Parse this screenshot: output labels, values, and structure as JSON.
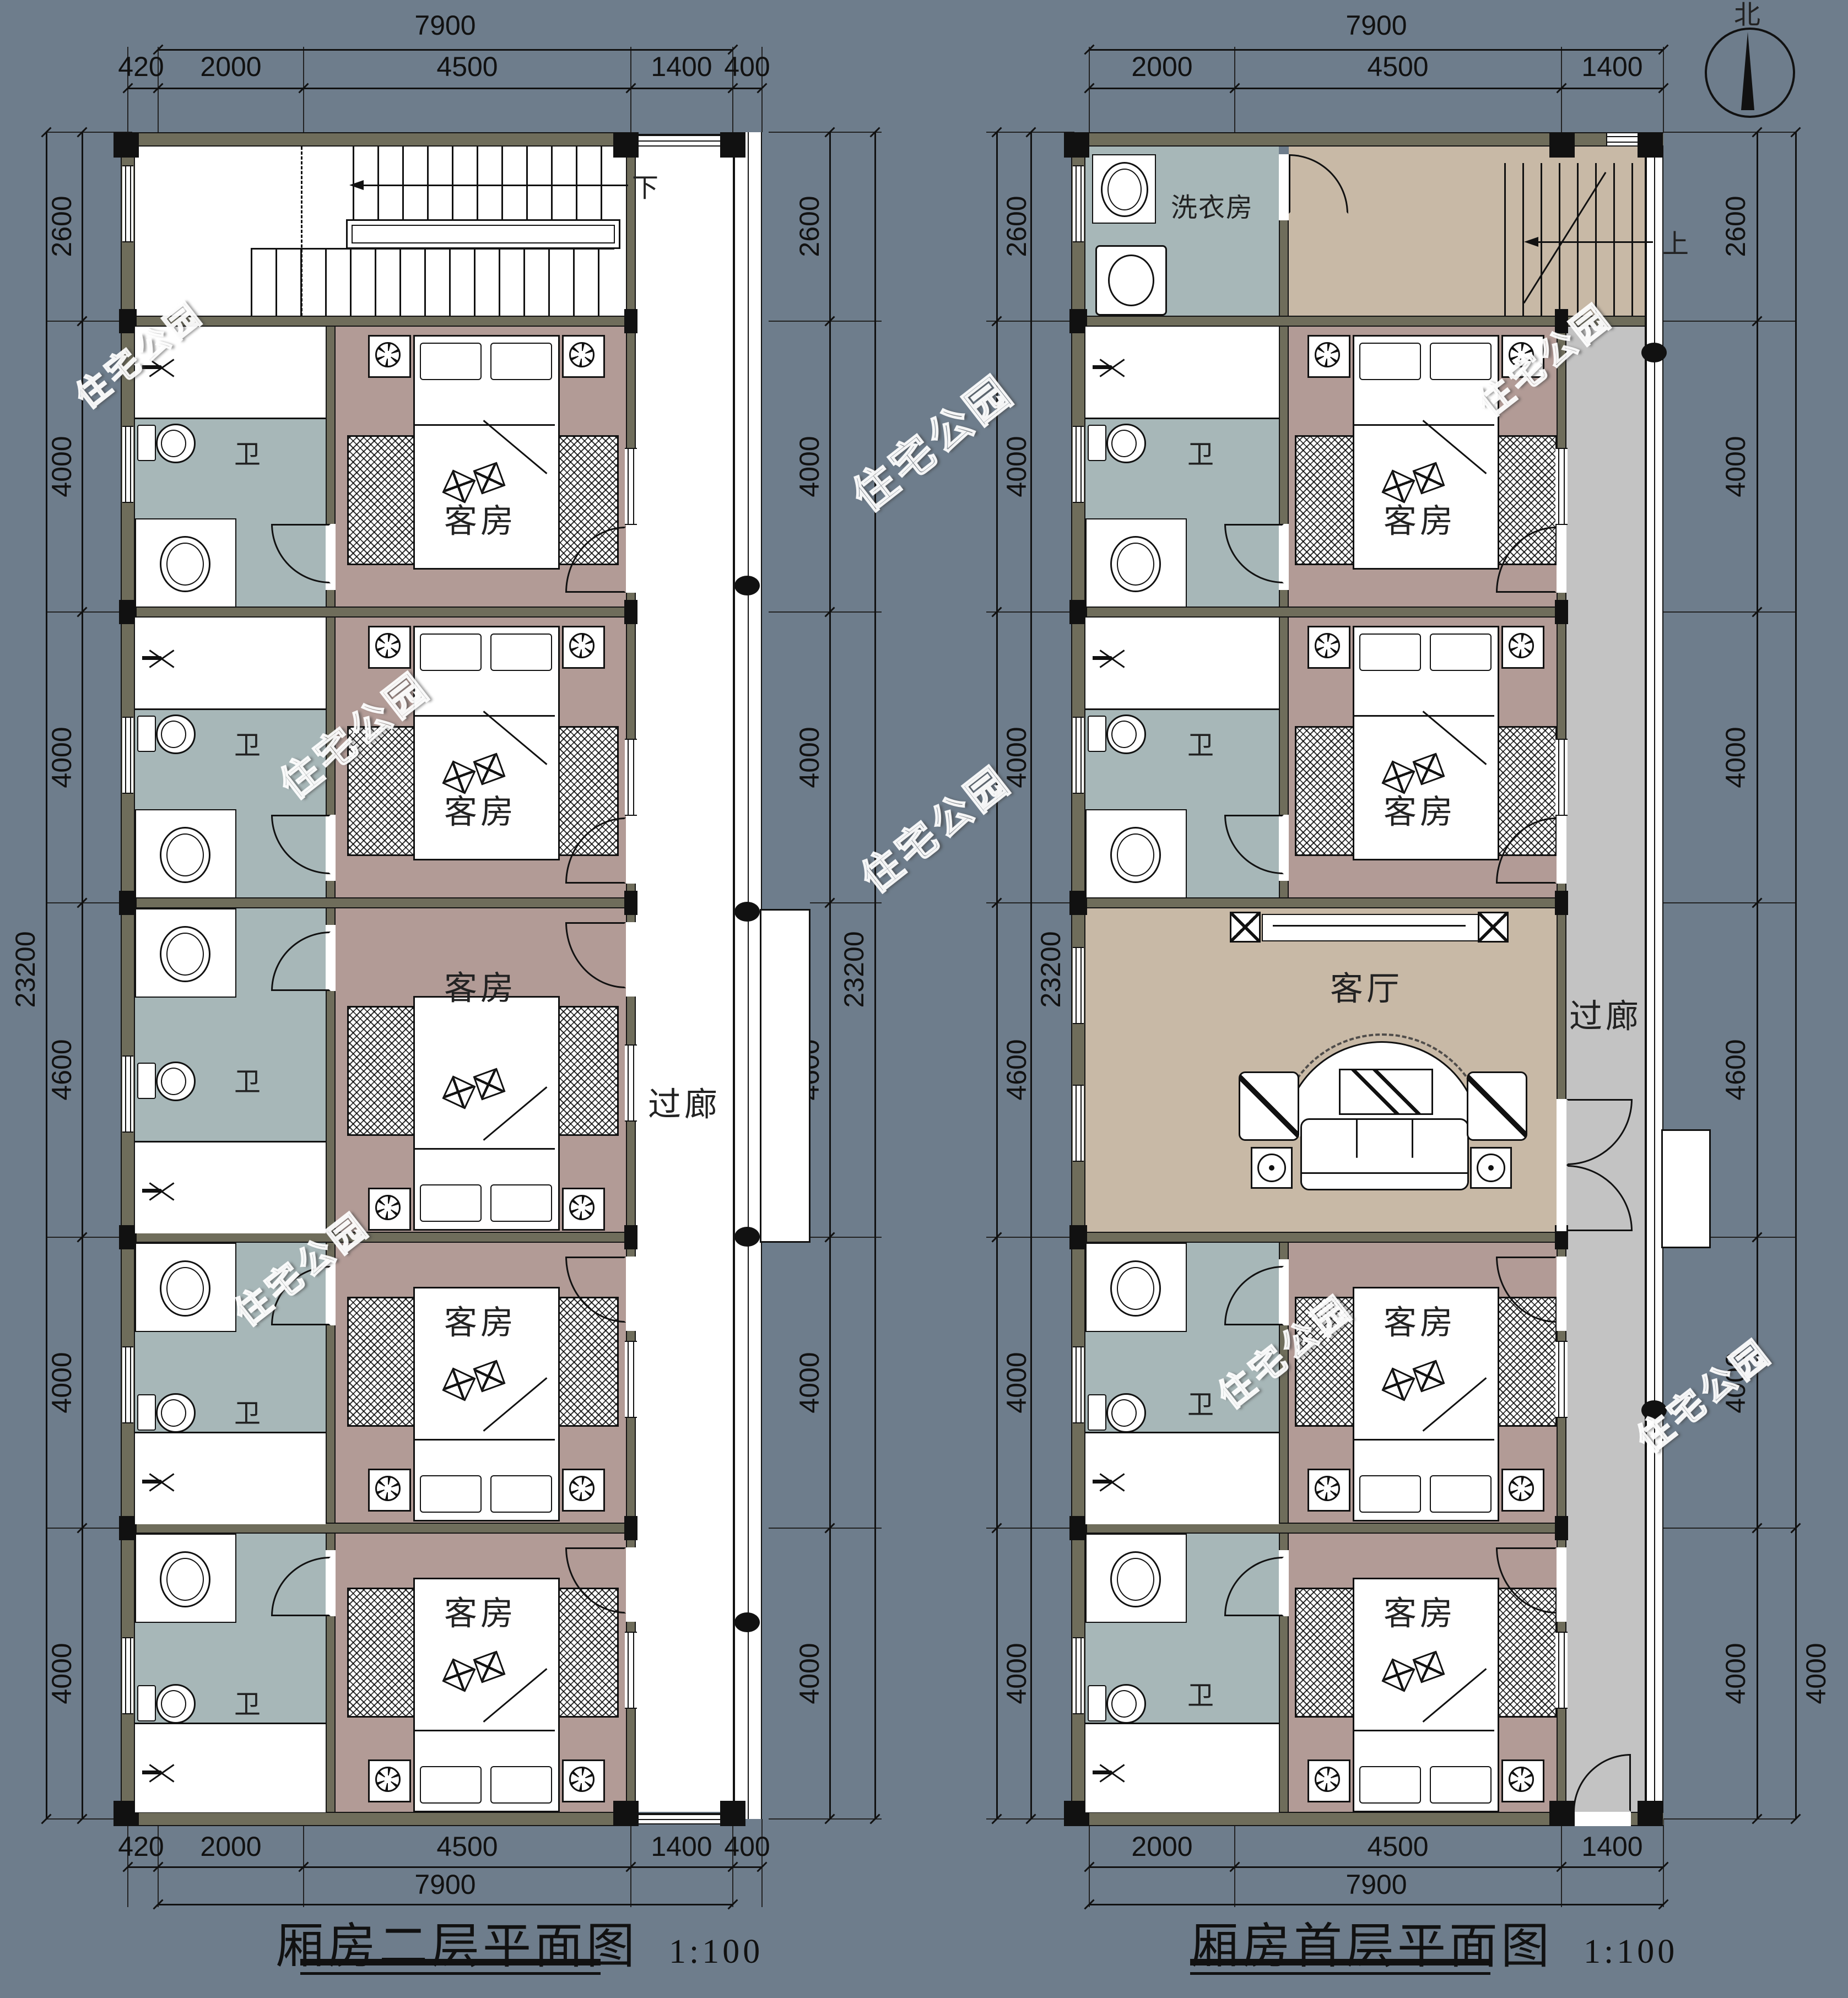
{
  "sheet": {
    "background_color": "#6e7d8c"
  },
  "colors": {
    "wall": "#6f6d5b",
    "line": "#111111",
    "bathroom_floor": "#a7b7b8",
    "bedroom_floor": "#b29b96",
    "living_floor": "#c8b9a6",
    "corridor_first_floor": "#c3c3c3",
    "corridor_second_floor": "#ffffff"
  },
  "watermark": "住宅公园",
  "compass": {
    "north_label": "北"
  },
  "room_labels": {
    "guest_room": "客房",
    "bathroom": "卫",
    "living_room": "客厅",
    "laundry": "洗衣房",
    "corridor": "过廊",
    "stairs_down": "下",
    "stairs_up": "上"
  },
  "left_plan": {
    "title": "厢房二层平面图",
    "scale_note": "1:100",
    "dims": {
      "top_overall": "7900",
      "top_segments": [
        "420",
        "2000",
        "4500",
        "1400",
        "400"
      ],
      "bottom_segments": [
        "420",
        "2000",
        "4500",
        "1400",
        "400"
      ],
      "bottom_overall": "7900",
      "left_segments": [
        "2600",
        "4000",
        "4000",
        "4600",
        "4000",
        "4000"
      ],
      "left_overall": "23200",
      "right_segments": [
        "2600",
        "4000",
        "4000",
        "4600",
        "4000",
        "4000"
      ],
      "right_overall": "23200"
    }
  },
  "right_plan": {
    "title": "厢房首层平面图",
    "scale_note": "1:100",
    "dims": {
      "top_overall": "7900",
      "top_segments": [
        "2000",
        "4500",
        "1400"
      ],
      "bottom_segments": [
        "2000",
        "4500",
        "1400"
      ],
      "bottom_overall": "7900",
      "left_segments": [
        "2600",
        "4000",
        "4000",
        "4600",
        "4000",
        "4000"
      ],
      "left_overall": "23200",
      "right_segments": [
        "2600",
        "4000",
        "4000",
        "4600",
        "4000",
        "4000"
      ],
      "right_outer_extra": "4000"
    }
  }
}
